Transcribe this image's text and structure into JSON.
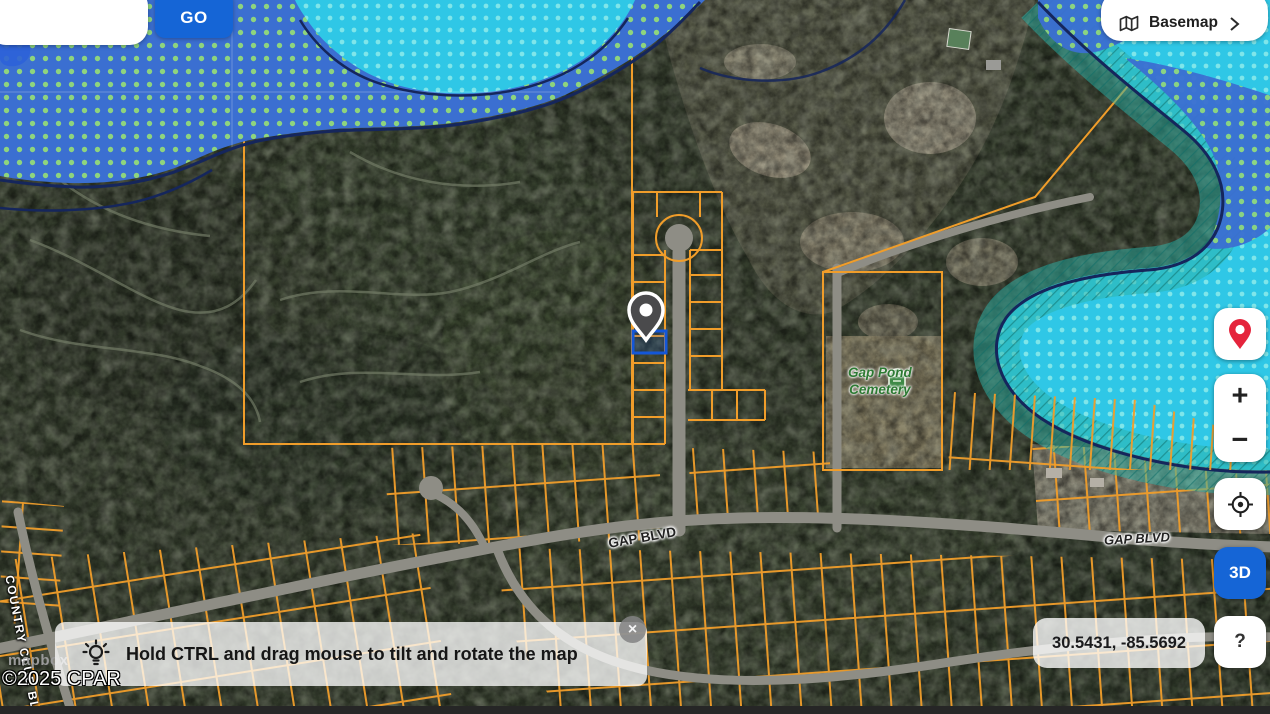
{
  "header": {
    "search": {
      "value": "",
      "placeholder": ""
    },
    "go_button_label": "GO",
    "basemap": {
      "label": "Basemap"
    }
  },
  "controls": {
    "zoom_in_label": "+",
    "zoom_out_label": "−",
    "three_d_label": "3D",
    "help_label": "?"
  },
  "statusbar": {
    "coordinates": "30.5431, -85.5692"
  },
  "tip_banner": {
    "text": "Hold CTRL and drag mouse to tilt and rotate the map",
    "close_label": "×"
  },
  "attribution": {
    "mapbox_wordmark": "mapbox",
    "copyright": "©2025 CPAR"
  },
  "map_labels": {
    "gap_blvd_main": "GAP BLVD",
    "gap_blvd_east": "GAP BLVD",
    "cemetery_name_line1": "Gap Pond",
    "cemetery_name_line2": "Cemetery",
    "country_club_road": "COUNTRY CLUB BLVD"
  },
  "colors": {
    "accent_blue": "#1565d6",
    "flood_blue": "#3b6fd1",
    "flood_cyan": "#2fc7e6",
    "flood_teal": "#2aa89c",
    "parcel_orange": "#f09d2a",
    "selection_blue": "#1457d8",
    "marker_gray": "#4a4a4c",
    "pin_red": "#e5243c"
  }
}
